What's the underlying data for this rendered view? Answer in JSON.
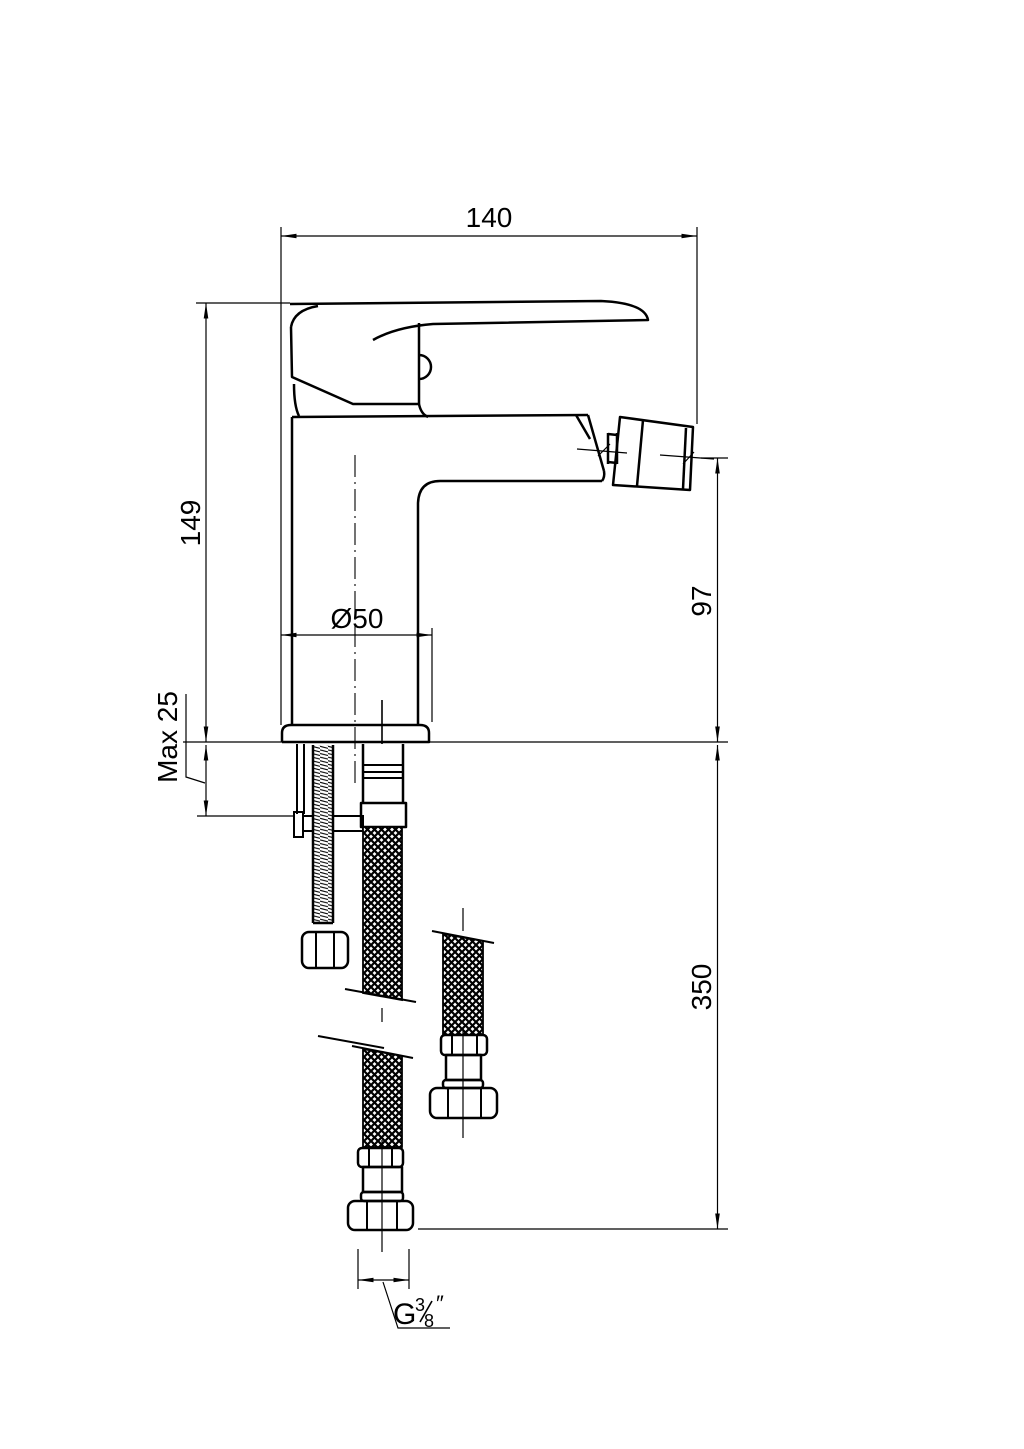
{
  "colors": {
    "ink": "#000000",
    "paper": "#ffffff"
  },
  "dimensions": {
    "spout_reach": "140",
    "body_height": "149",
    "deck_thickness": "Max 25",
    "spout_height": "97",
    "hose_length": "350",
    "base_diameter": "Ø50",
    "thread_g": "G",
    "thread_numerator": "3",
    "thread_denominator": "8",
    "thread_inch_mark": "″"
  }
}
